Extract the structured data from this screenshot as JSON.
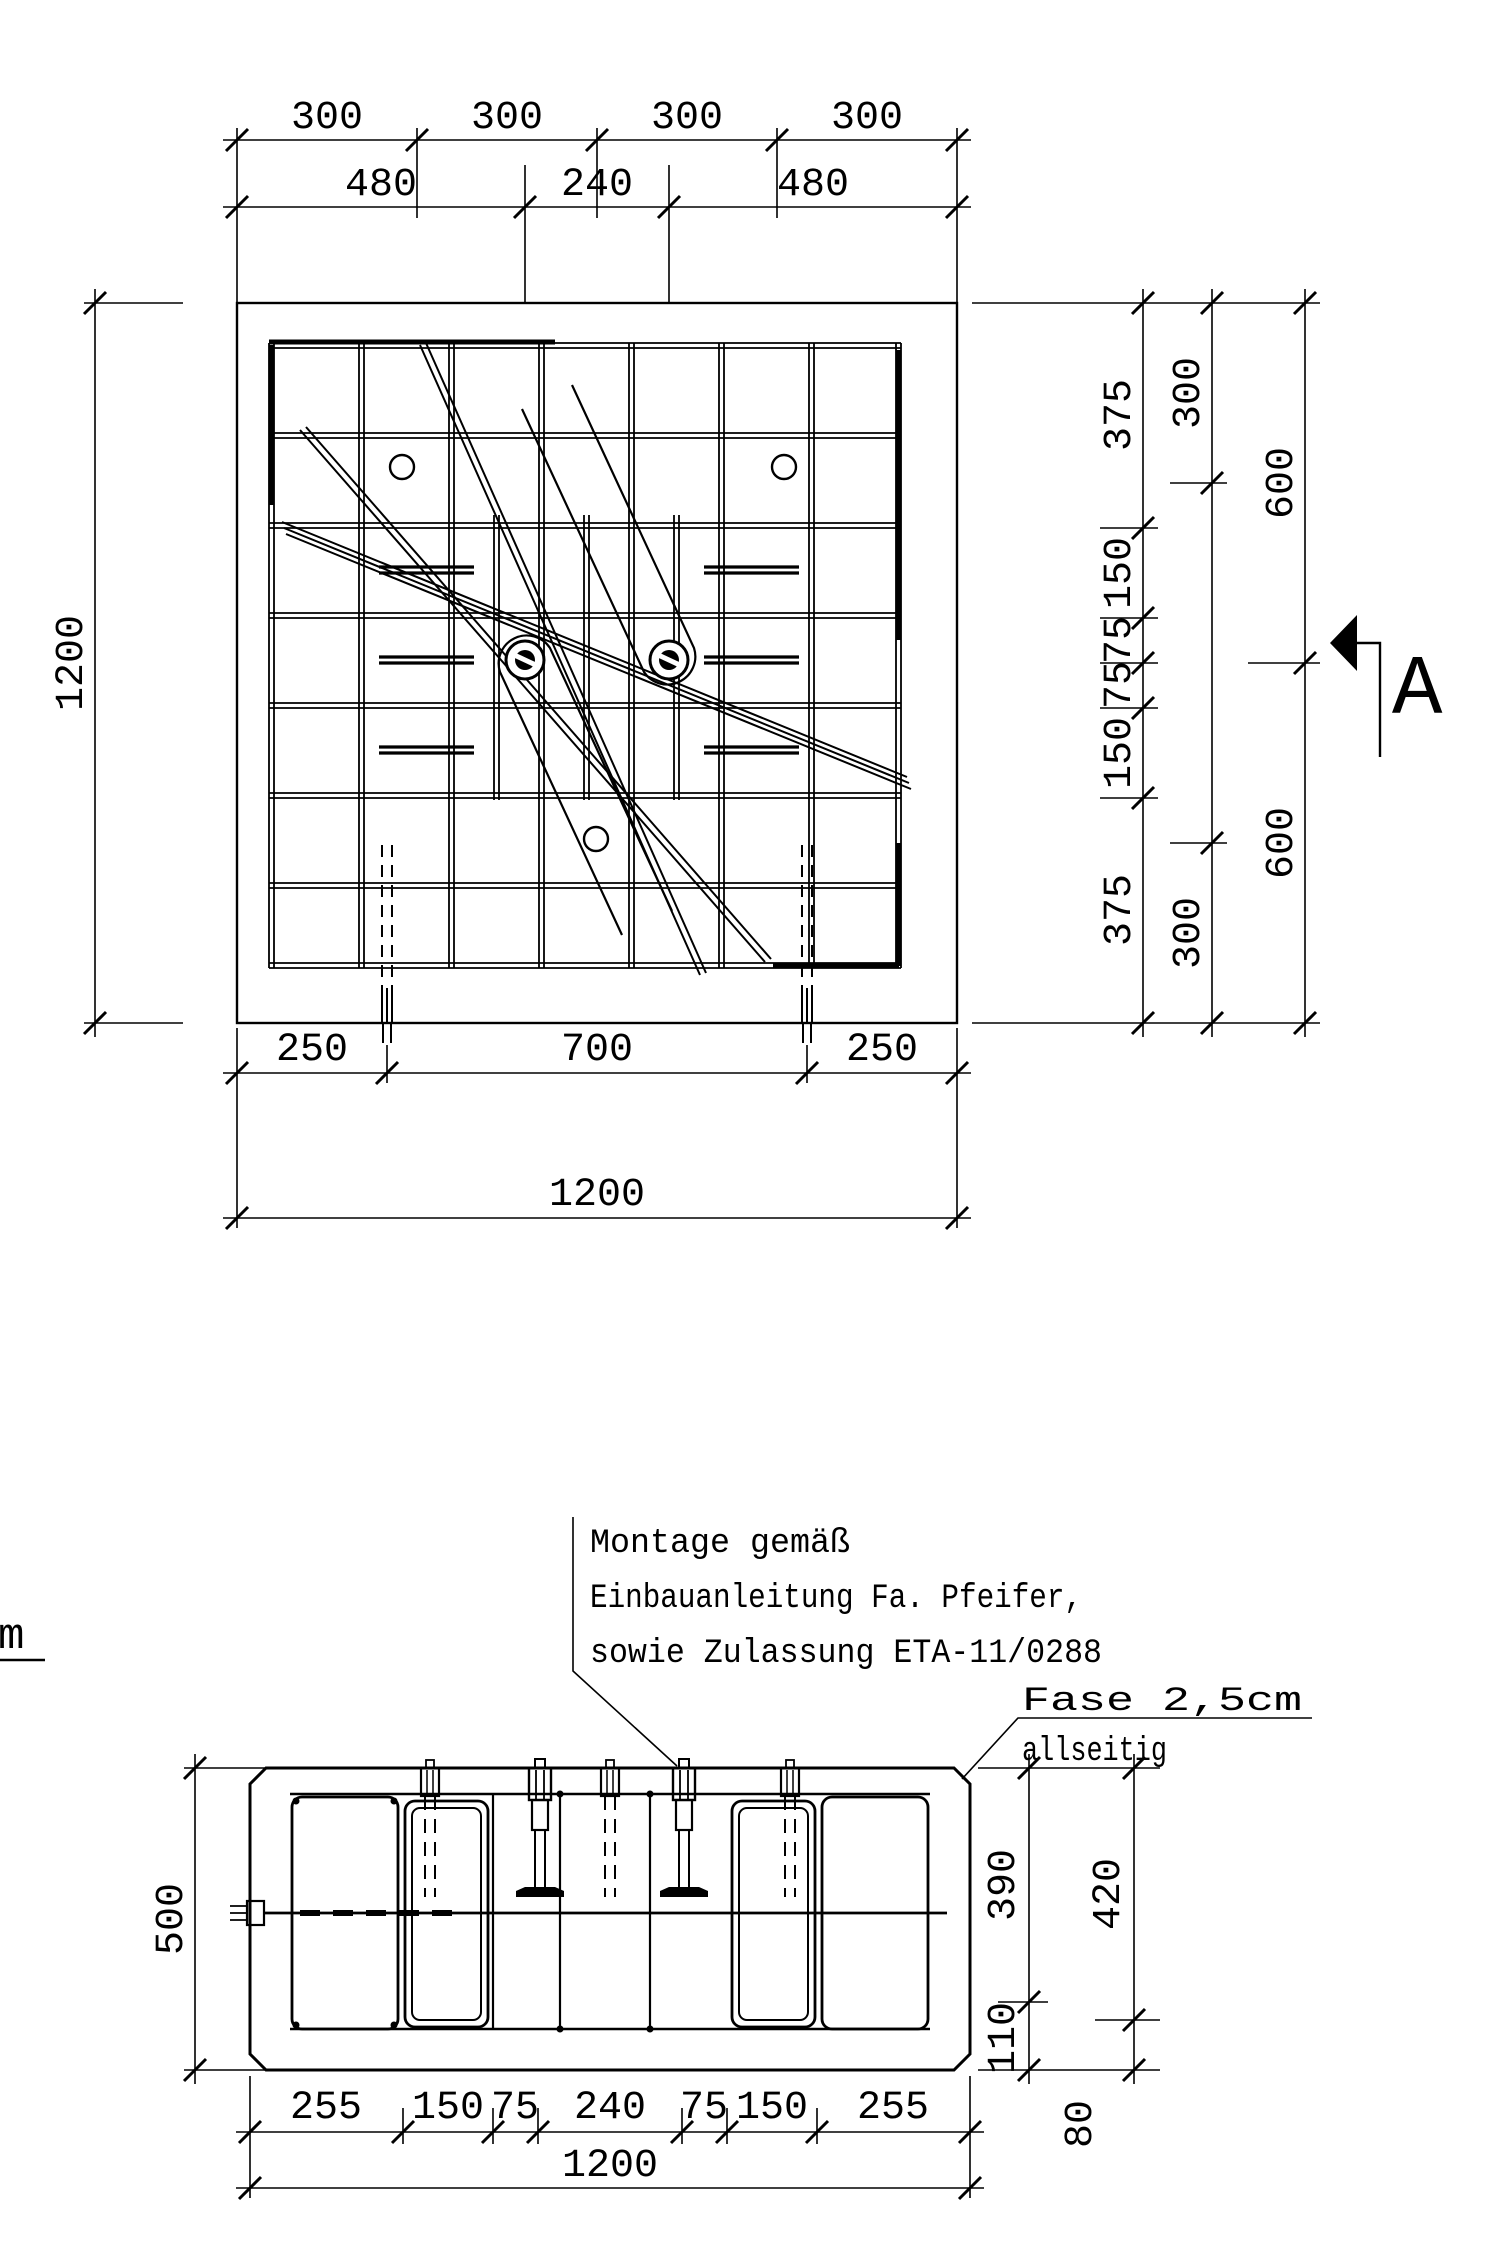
{
  "plan": {
    "top_chain_outer": [
      "300",
      "300",
      "300",
      "300"
    ],
    "top_chain_inner": [
      "480",
      "240",
      "480"
    ],
    "left_total": "1200",
    "bottom_chain": [
      "250",
      "700",
      "250"
    ],
    "bottom_total": "1200",
    "right_chain_bars": [
      "375",
      "150",
      "75",
      "75",
      "150",
      "375"
    ],
    "right_chain_mid": [
      "300",
      "300"
    ],
    "right_chain_outer": [
      "600",
      "600"
    ],
    "section_marker_label": "A"
  },
  "section": {
    "left_total": "500",
    "right_chain_inner": [
      "390",
      "110"
    ],
    "right_chain_outer": [
      "420",
      "80"
    ],
    "bottom_chain": [
      "255",
      "150",
      "75",
      "240",
      "75",
      "150",
      "255"
    ],
    "bottom_total": "1200"
  },
  "notes": {
    "montage_lines": [
      "Montage gemäß",
      "Einbauanleitung Fa. Pfeifer,",
      "sowie Zulassung ETA-11/0288"
    ],
    "fase_lines": [
      "Fase 2,5cm",
      "allseitig"
    ],
    "left_cutoff": "m"
  }
}
